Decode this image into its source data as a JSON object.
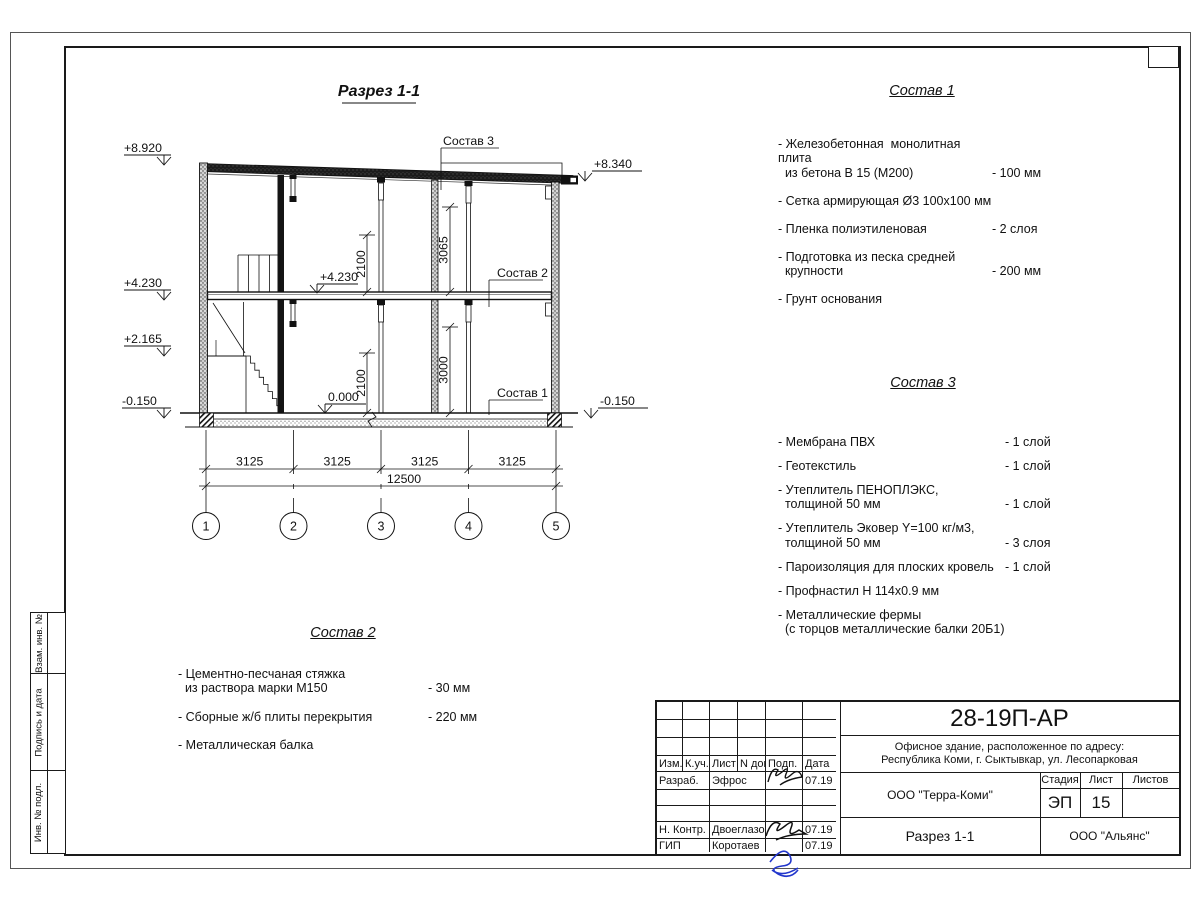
{
  "side_strip": {
    "items": [
      "Взам. инв. №",
      "Подпись и дата",
      "Инв. № подл."
    ]
  },
  "drawing": {
    "title": "Разрез 1-1",
    "elevations": {
      "left_top": "+8.920",
      "left_floor2": "+4.230",
      "left_stair": "+2.165",
      "left_base": "-0.150",
      "right_top": "+8.340",
      "right_base": "-0.150",
      "inner_floor2": "+4.230",
      "inner_zero": "0.000"
    },
    "dims": {
      "upper_left": "2100",
      "upper_right": "3065",
      "lower_left": "2100",
      "lower_right": "3000",
      "spans": [
        "3125",
        "3125",
        "3125",
        "3125"
      ],
      "total": "12500"
    },
    "axes": [
      "1",
      "2",
      "3",
      "4",
      "5"
    ],
    "callouts": {
      "c1": "Состав 1",
      "c2": "Состав 2",
      "c3": "Состав 3"
    }
  },
  "lists": {
    "sostav1": {
      "title": "Состав 1",
      "items": [
        {
          "text": "- Железобетонная  монолитная плита\n  из бетона В 15 (М200)",
          "value": "- 100 мм"
        },
        {
          "text": "- Сетка армирующая Ø3 100х100 мм",
          "value": ""
        },
        {
          "text": "- Пленка полиэтиленовая",
          "value": "-  2 слоя"
        },
        {
          "text": "- Подготовка из песка средней\n  крупности",
          "value": "- 200 мм"
        },
        {
          "text": "- Грунт основания",
          "value": ""
        }
      ]
    },
    "sostav2": {
      "title": "Состав 2",
      "items": [
        {
          "text": "- Цементно-песчаная стяжка\n  из раствора марки М150",
          "value": "- 30 мм"
        },
        {
          "text": "- Сборные ж/б плиты перекрытия",
          "value": "- 220 мм"
        },
        {
          "text": "- Металлическая балка",
          "value": ""
        }
      ]
    },
    "sostav3": {
      "title": "Состав 3",
      "items": [
        {
          "text": "- Мембрана ПВХ",
          "value": "- 1 слой"
        },
        {
          "text": "- Геотекстиль",
          "value": "- 1 слой"
        },
        {
          "text": "- Утеплитель ПЕНОПЛЭКС,\n  толщиной 50 мм",
          "value": "- 1 слой"
        },
        {
          "text": "- Утеплитель Эковер Y=100 кг/м3,\n  толщиной 50 мм",
          "value": "- 3 слоя"
        },
        {
          "text": "- Пароизоляция для плоских кровель",
          "value": "- 1 слой"
        },
        {
          "text": "- Профнастил Н 114х0.9 мм",
          "value": ""
        },
        {
          "text": "- Металлические фермы\n  (с торцов металлические балки 20Б1)",
          "value": ""
        }
      ]
    }
  },
  "titleblock": {
    "doc_number": "28-19П-АР",
    "address_line1": "Офисное здание, расположенное по адресу:",
    "address_line2": "Республика Коми, г. Сыктывкар, ул. Лесопарковая",
    "header_cols": [
      "Изм.",
      "К.уч.",
      "Лист",
      "N док.",
      "Подп.",
      "Дата"
    ],
    "rows": {
      "developer_label": "Разраб.",
      "developer_name": "Эфрос",
      "developer_date": "07.19",
      "ncontrol_label": "Н. Контр.",
      "ncontrol_name": "Двоеглазов",
      "ncontrol_date": "07.19",
      "gip_label": "ГИП",
      "gip_name": "Коротаев",
      "gip_date": "07.19"
    },
    "org_middle": "ООО \"Терра-Коми\"",
    "stage_header": [
      "Стадия",
      "Лист",
      "Листов"
    ],
    "stage_values": {
      "stage": "ЭП",
      "sheet": "15",
      "sheets": ""
    },
    "sheet_title": "Разрез 1-1",
    "org_bottom": "ООО \"Альянс\""
  }
}
